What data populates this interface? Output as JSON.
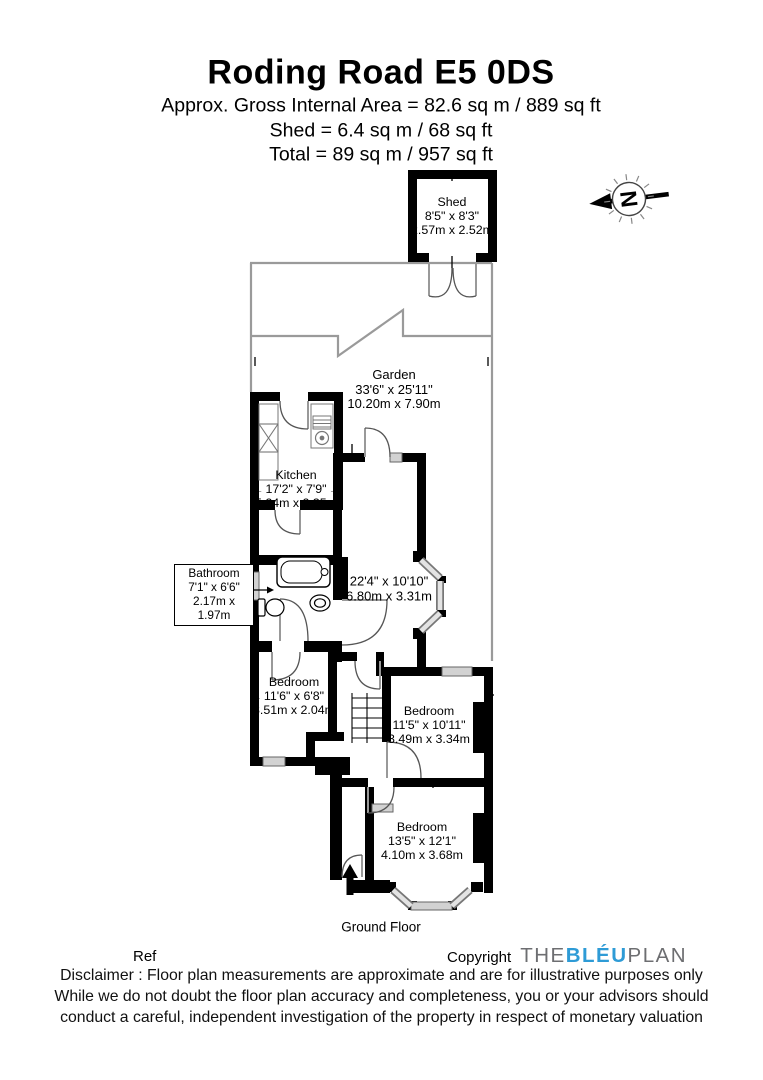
{
  "header": {
    "title": "Roding Road E5 0DS",
    "area_line": "Approx. Gross Internal Area = 82.6 sq m / 889 sq ft",
    "shed_line": "Shed = 6.4 sq m / 68 sq ft",
    "total_line": "Total = 89 sq m / 957 sq ft"
  },
  "compass": {
    "letter": "N"
  },
  "rooms": {
    "shed": {
      "name": "Shed",
      "imperial": "8'5\" x 8'3\"",
      "metric": "2.57m x 2.52m"
    },
    "garden": {
      "name": "Garden",
      "imperial": "33'6\" x 25'11\"",
      "metric": "10.20m x 7.90m"
    },
    "kitchen": {
      "name": "Kitchen",
      "imperial": "17'2\" x 7'9\"",
      "metric": "5.24m x 2.35m"
    },
    "bathroom": {
      "name": "Bathroom",
      "imperial": "7'1\" x 6'6\"",
      "metric": "2.17m x 1.97m"
    },
    "reception": {
      "imperial": "22'4\" x 10'10\"",
      "metric": "6.80m x 3.31m"
    },
    "bedroom_left": {
      "name": "Bedroom",
      "imperial": "11'6\" x 6'8\"",
      "metric": "3.51m x 2.04m"
    },
    "bedroom_middle": {
      "name": "Bedroom",
      "imperial": "11'5\" x 10'11\"",
      "metric": "3.49m x 3.34m"
    },
    "bedroom_front": {
      "name": "Bedroom",
      "imperial": "13'5\" x 12'1\"",
      "metric": "4.10m x 3.68m"
    }
  },
  "floor_label": "Ground Floor",
  "footer": {
    "ref_label": "Ref",
    "copyright_label": "Copyright",
    "logo": {
      "part1": "THE",
      "part2": "BLÉU",
      "part3": "PLAN"
    },
    "disclaimer_line1": "Disclaimer : Floor plan measurements are approximate and are for illustrative purposes only",
    "disclaimer_line2": "While we do not doubt the floor plan accuracy and completeness, you or your advisors should",
    "disclaimer_line3": "conduct a careful, independent investigation of the property in respect of monetary valuation"
  },
  "colors": {
    "wall": "#000000",
    "window": "#d2d2d2",
    "garden_line": "#9a9a9a",
    "logo_blue": "#2e9bd6",
    "logo_gray": "#6d6e71"
  }
}
